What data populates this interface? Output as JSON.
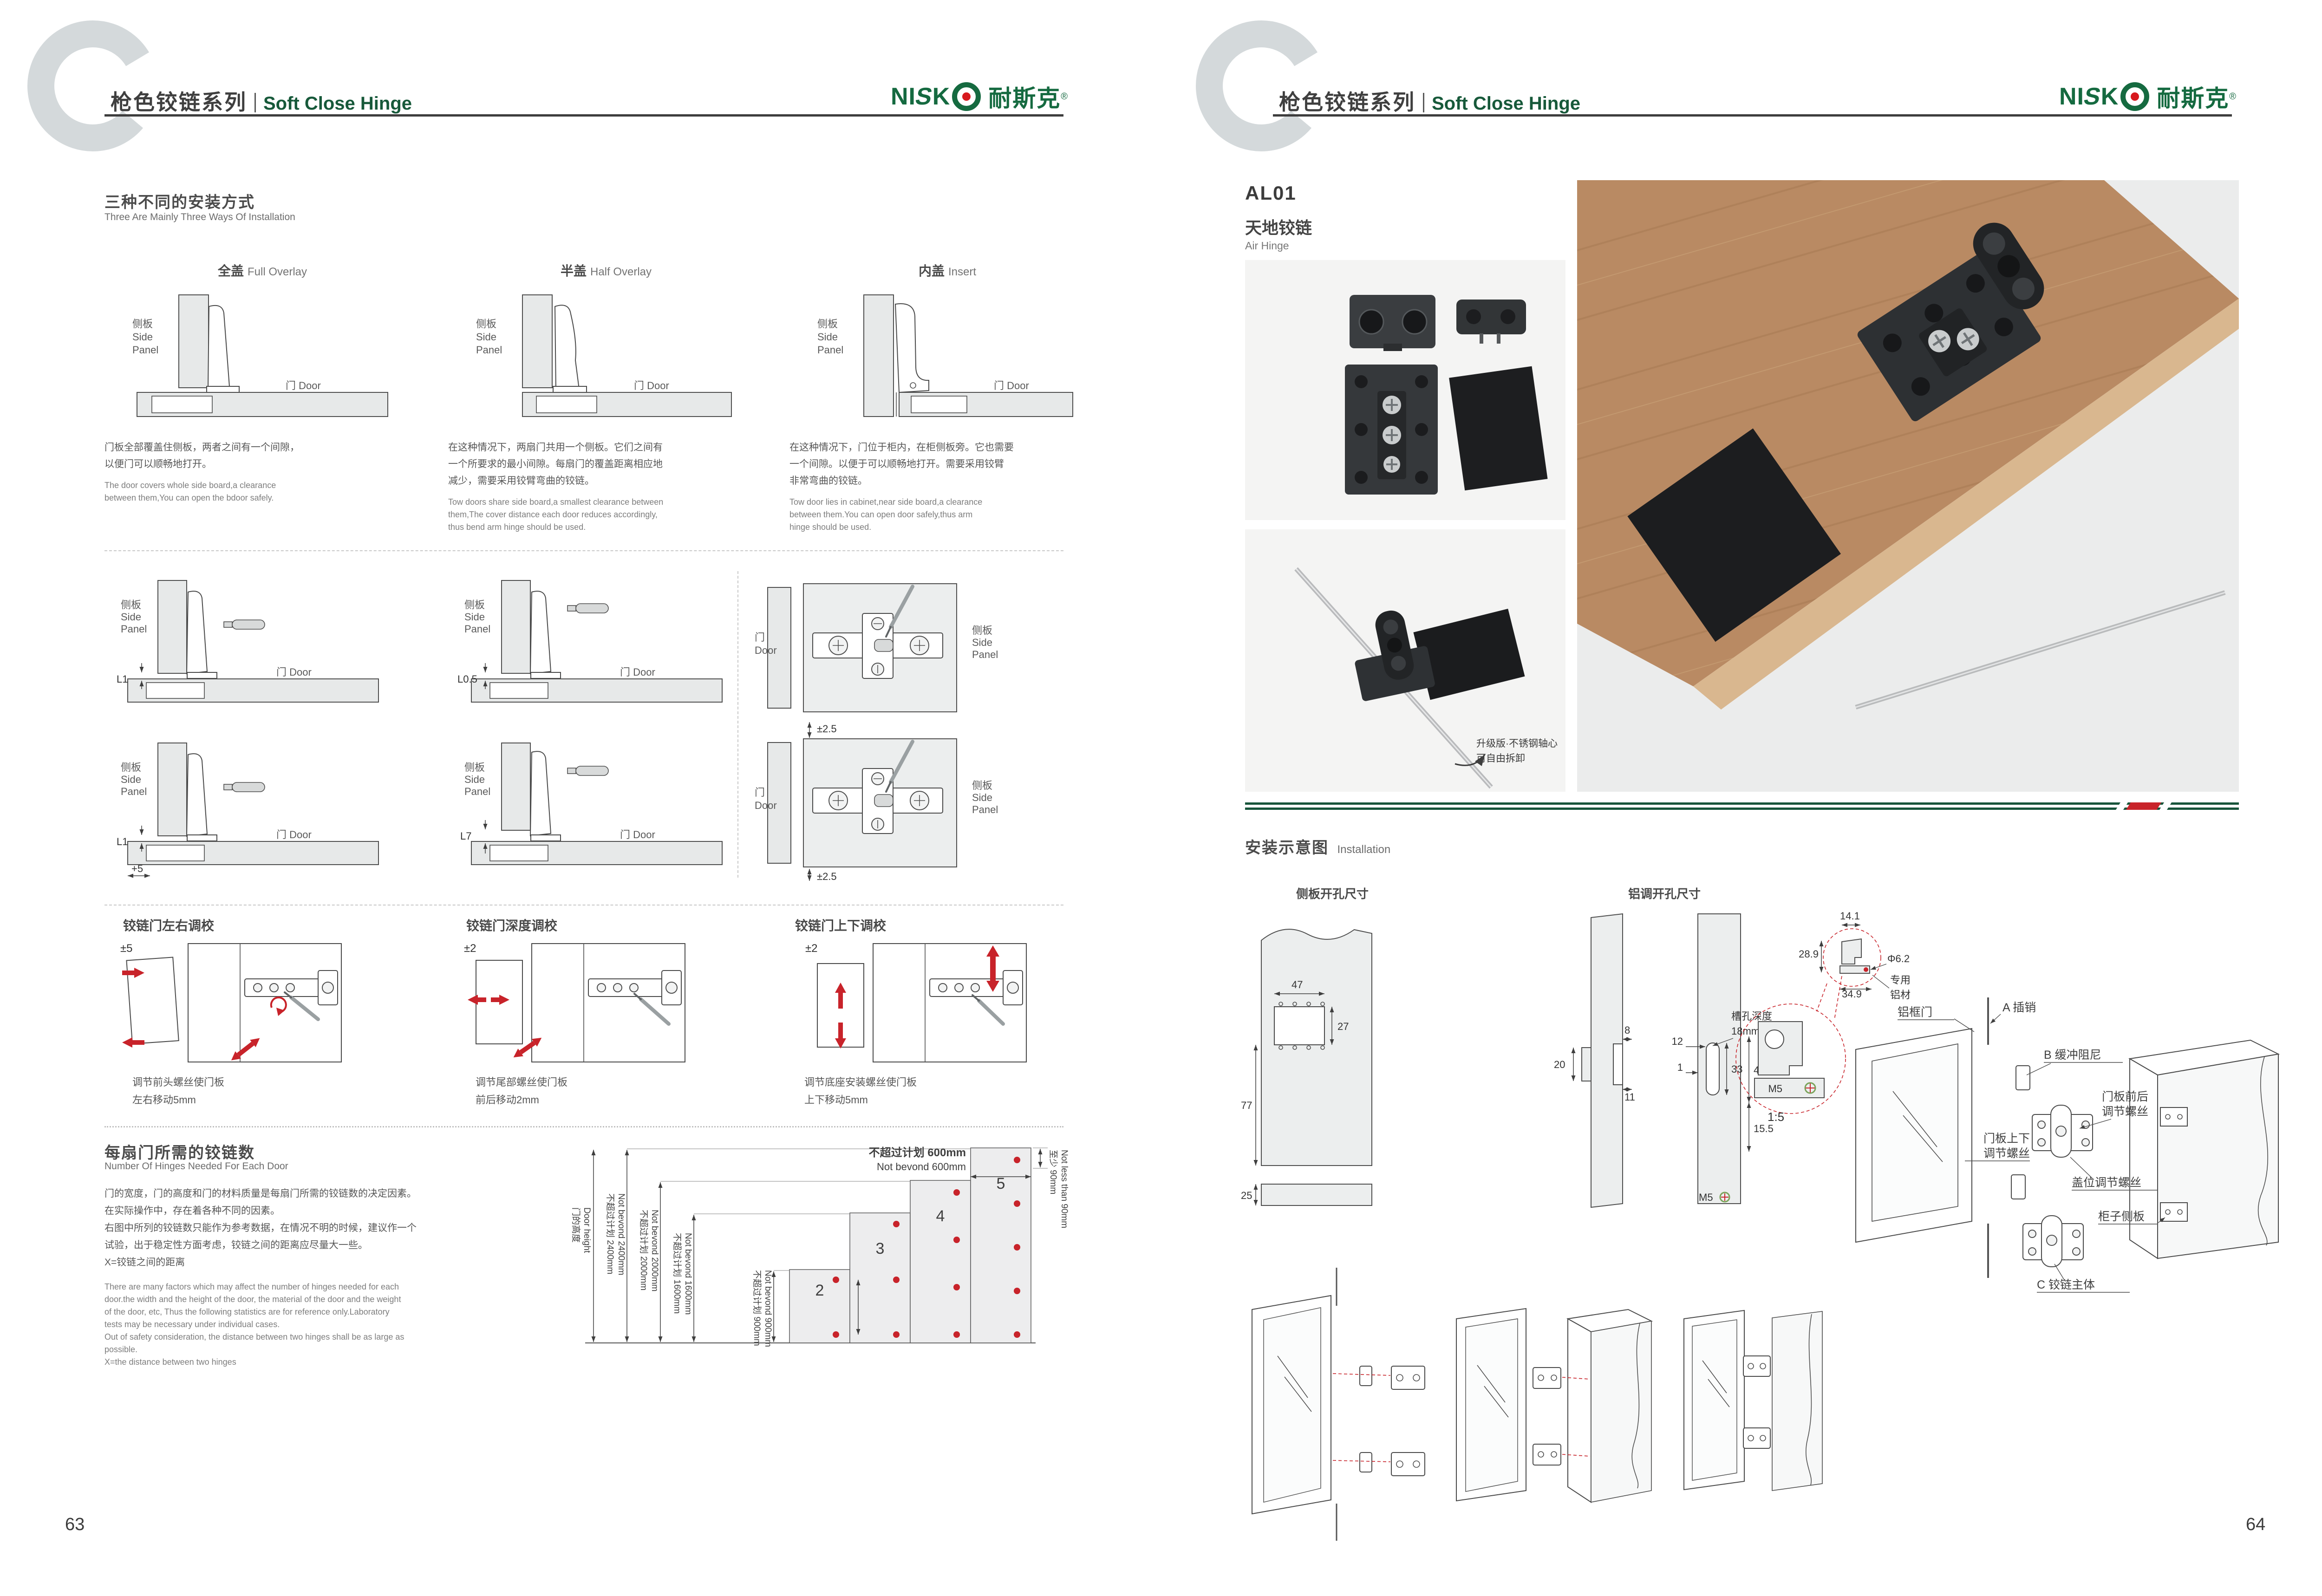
{
  "colors": {
    "brand_green": "#156A40",
    "header_green": "#17593A",
    "accent_red": "#C8232A",
    "header_rule": "#3D3D3D",
    "panel_fill": "#E7E9E9",
    "photo_bg": "#F4F4F3",
    "wood": "#B98A63",
    "watermark": "#D4D9DB"
  },
  "header": {
    "series_cn": "枪色铰链系列",
    "series_en": "Soft Close Hinge",
    "logo": {
      "n": "NI",
      "s": "S",
      "k": "K",
      "cjk": "耐斯克",
      "reg": "®"
    }
  },
  "shared": {
    "side_panel_cn": "侧板",
    "side_en_1": "Side",
    "side_en_2": "Panel",
    "door_cn": "门",
    "door_en": "Door",
    "door_cn_en": "门 Door"
  },
  "page63": {
    "number": "63",
    "ways": {
      "title_cn": "三种不同的安装方式",
      "title_en": "Three Are Mainly Three Ways Of Installation",
      "m1": {
        "cn": "全盖",
        "en": "Full Overlay",
        "desc_cn": "门板全部覆盖住侧板，两者之间有一个间隙，\n以便门可以顺畅地打开。",
        "desc_en": "The door covers whole side board,a clearance\nbetween them,You can open the bdoor safely."
      },
      "m2": {
        "cn": "半盖",
        "en": "Half Overlay",
        "desc_cn": "在这种情况下，两扇门共用一个侧板。它们之间有\n一个所要求的最小间隙。每扇门的覆盖距离相应地\n减少，需要采用铰臂弯曲的铰链。",
        "desc_en": "Tow doors share side board,a smallest clearance between\nthem,The cover distance each door reduces accordingly,\nthus bend arm hinge should be used."
      },
      "m3": {
        "cn": "内盖",
        "en": "Insert",
        "desc_cn": "在这种情况下，门位于柜内，在柜侧板旁。它也需要\n一个间隙。以便于可以顺畅地打开。需要采用铰臂\n非常弯曲的铰链。",
        "desc_en": "Tow door lies in cabinet,near side board,a clearance\nbetween them.You can open door safely,thus arm\nhinge should be used."
      }
    },
    "gaps": {
      "g1": "L1",
      "g2": "L0.5",
      "g3": "L1",
      "g3b": "+5",
      "g4": "L7",
      "p1": "±2.5",
      "p2": "±2.5"
    },
    "adjust": {
      "a1": {
        "title": "铰链门左右调校",
        "tol": "±5",
        "cap": "调节前头螺丝使门板\n左右移动5mm"
      },
      "a2": {
        "title": "铰链门深度调校",
        "tol": "±2",
        "cap": "调节尾部螺丝使门板\n前后移动2mm"
      },
      "a3": {
        "title": "铰链门上下调校",
        "tol": "±2",
        "cap": "调节底座安装螺丝使门板\n上下移动5mm"
      }
    },
    "hinges": {
      "title_cn": "每扇门所需的铰链数",
      "title_en": "Number Of Hinges Needed For Each Door",
      "desc_cn": "门的宽度，门的高度和门的材料质量是每扇门所需的铰链数的决定因素。\n在实际操作中，存在着各种不同的因素。\n右图中所列的铰链数只能作为参考数据，在情况不明的时候，建议作一个\n试验，出于稳定性方面考虑，铰链之间的距离应尽量大一些。\nX=铰链之间的距离",
      "desc_en": "There are many factors which may affect the number of hinges needed for each\ndoor.the width and the height of the door, the material of the door and the weight\nof the door, etc, Thus the following statistics are for reference only.Laboratory\ntests may be necessary under individual cases.\nOut of safety consideration, the distance between two hinges shall be as large as\npossible.\nX=the distance between two hinges"
    }
  },
  "chart_data": {
    "type": "bar",
    "title": "每扇门所需的铰链数 Number Of Hinges Needed For Each Door",
    "categories": [
      "≤900mm",
      "≤1600mm",
      "≤2000mm",
      "≤2400mm"
    ],
    "values": [
      2,
      3,
      4,
      5
    ],
    "ylabel": "门的高度 Door height",
    "ylim": [
      0,
      2400
    ],
    "grid": false,
    "notes": "red dots mark hinge positions on each door bar; min distance from door edge 90mm; door width not beyond 600mm",
    "labels": {
      "height_cn": "门的高度",
      "height_en": "Door height",
      "h2400_cn": "不超过计划 2400mm",
      "h2400_en": "Not bevond 2400mm",
      "h2000_cn": "不超过计划 2000mm",
      "h2000_en": "Not bevond 2000mm",
      "h1600_cn": "不超过计划 1600mm",
      "h1600_en": "Not bevond 1600mm",
      "h900_cn": "不超过计划 900mm",
      "h900_en": "Not bevond 900mm",
      "w600_cn": "不超过计划 600mm",
      "w600_en": "Not bevond 600mm",
      "min90_cn": "至少 90mm",
      "min90_en": "Not less than 90mm",
      "n2": "2",
      "n3": "3",
      "n4": "4",
      "n5": "5"
    }
  },
  "page64": {
    "number": "64",
    "code": "AL01",
    "name_cn": "天地铰链",
    "name_en": "Air Hinge",
    "photo_note1": "升级版·不锈钢轴心",
    "photo_note2": "可自由拆卸",
    "install": {
      "title_cn": "安装示意图",
      "title_en": "Installation",
      "d1": {
        "title": "侧板开孔尺寸",
        "w": "47",
        "h": "27",
        "hh": "77",
        "t": "25"
      },
      "d2": {
        "title": "铝调开孔尺寸",
        "a": "8",
        "b": "20",
        "c": "11",
        "d": "12",
        "e": "1",
        "f": "33",
        "g": "46",
        "h": "15.5",
        "m5": "M5",
        "slot1": "槽孔深度",
        "slot2": "18mm"
      },
      "detail": {
        "a": "14.1",
        "b": "28.9",
        "c": "34.9",
        "dia": "Φ6.2",
        "note1": "专用",
        "note2": "铝材",
        "m5": "M5",
        "scale": "1:5"
      },
      "ex": {
        "door": "铝框门",
        "pin": "A 插销",
        "damper": "B 缓冲阻尼",
        "ud1": "门板上下",
        "ud2": "调节螺丝",
        "fb1": "门板前后",
        "fb2": "调节螺丝",
        "cover": "盖位调节螺丝",
        "cabinet": "柜子侧板",
        "body": "C 铰链主体"
      }
    }
  }
}
